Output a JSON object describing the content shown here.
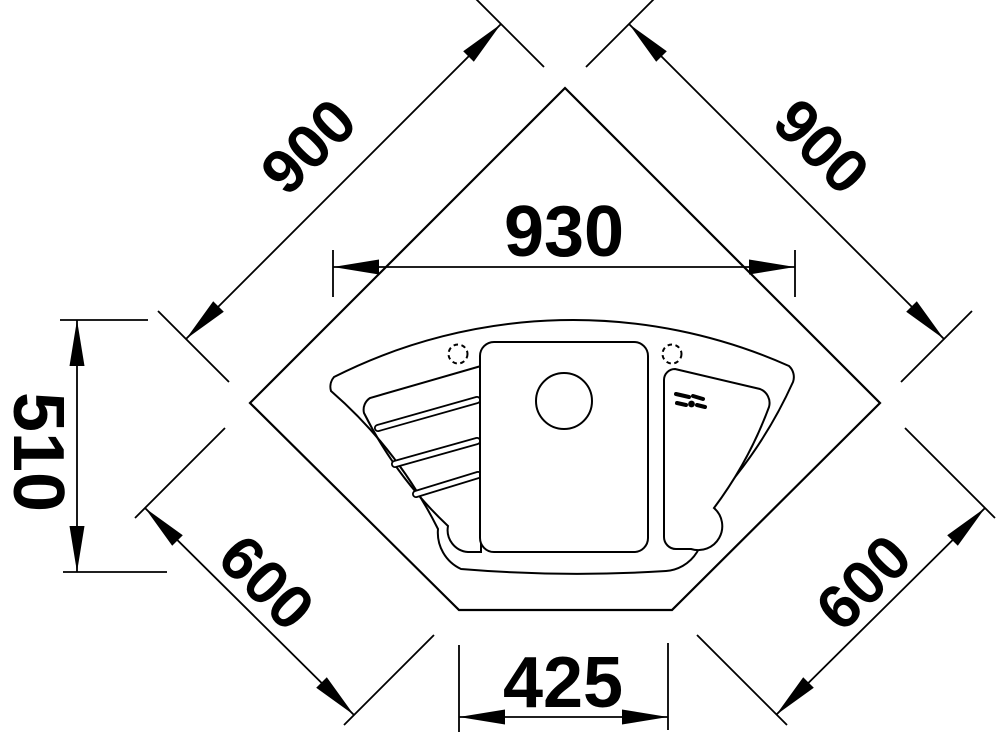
{
  "drawing": {
    "type": "technical-dimension-drawing",
    "subject": "corner sink top view",
    "units": "mm",
    "colors": {
      "line": "#000000",
      "background": "#ffffff"
    },
    "dimensions": {
      "rear_left_edge": "900",
      "rear_right_edge": "900",
      "sink_overall_width": "930",
      "sink_overall_depth": "510",
      "side_left_edge": "600",
      "side_right_edge": "600",
      "front_edge": "425"
    }
  }
}
